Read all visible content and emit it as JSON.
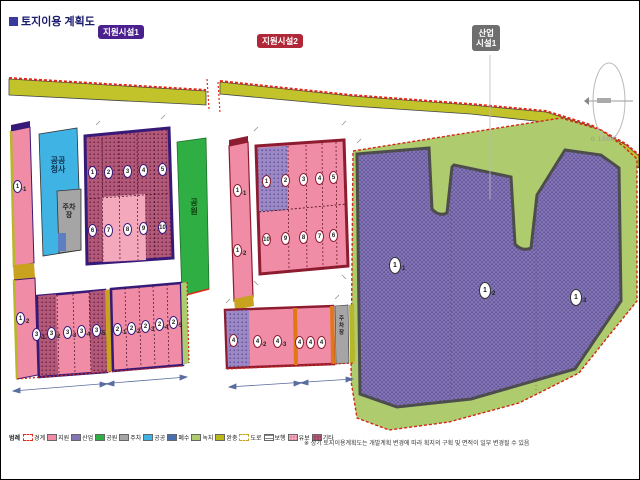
{
  "title": {
    "text": "토지이용 계획도"
  },
  "badges": {
    "support1": {
      "label": "지원시설1",
      "color": "#4a1f8e"
    },
    "support2": {
      "label": "지원시설2",
      "color": "#b02838"
    },
    "industry1": {
      "line1": "산업",
      "line2": "시설1",
      "color": "#6e6e6e"
    }
  },
  "north": {
    "scale": "0 100m"
  },
  "left": {
    "strip_top": {
      "n": "1",
      "s": "-1"
    },
    "strip_bottom": {
      "n": "1",
      "s": "-2"
    },
    "blue": {
      "l1": "공공",
      "l2": "청사"
    },
    "gray": {
      "l1": "주차",
      "l2": "장"
    },
    "park": {
      "l1": "공",
      "l2": "원"
    },
    "main": {
      "r1": [
        {
          "n": "1"
        },
        {
          "n": "2"
        },
        {
          "n": "3"
        },
        {
          "n": "4"
        },
        {
          "n": "5"
        }
      ],
      "r2": [
        {
          "n": "6"
        },
        {
          "n": "7"
        },
        {
          "n": "8"
        },
        {
          "n": "9"
        },
        {
          "n": "10"
        }
      ]
    },
    "ga": [
      {
        "n": "3",
        "s": "-1"
      },
      {
        "n": "3",
        "s": "-2"
      },
      {
        "n": "3",
        "s": "-3"
      },
      {
        "n": "3",
        "s": "-4"
      },
      {
        "n": "3",
        "s": "-5"
      }
    ],
    "gb": [
      {
        "n": "2",
        "s": "-1"
      },
      {
        "n": "2",
        "s": "-2"
      },
      {
        "n": "2",
        "s": "-3"
      },
      {
        "n": "2",
        "s": "-4"
      },
      {
        "n": "2",
        "s": "-5"
      }
    ]
  },
  "mid": {
    "strip": [
      {
        "n": "1",
        "s": "-1"
      },
      {
        "n": "1",
        "s": "-2"
      }
    ],
    "main": {
      "r1": [
        {
          "n": "1"
        },
        {
          "n": "2"
        },
        {
          "n": "3"
        },
        {
          "n": "4"
        },
        {
          "n": "5"
        }
      ],
      "r2": [
        {
          "n": "10"
        },
        {
          "n": "9"
        },
        {
          "n": "8"
        },
        {
          "n": "7"
        },
        {
          "n": "6"
        }
      ]
    },
    "bottom": [
      {
        "n": "4",
        "s": "-1"
      },
      {
        "n": "4",
        "s": "-2"
      },
      {
        "n": "4",
        "s": "-3"
      },
      {
        "n": "4",
        "s": "-4"
      },
      {
        "n": "4",
        "s": "-5"
      },
      {
        "n": "4",
        "s": "-6"
      }
    ],
    "gray": {
      "l1": "주",
      "l2": "차",
      "l3": "장"
    }
  },
  "right": {
    "lots": [
      {
        "n": "1",
        "s": "-1"
      },
      {
        "n": "1",
        "s": "-2"
      },
      {
        "n": "1",
        "s": "-3"
      }
    ]
  },
  "legend": {
    "intro": "범례",
    "items": [
      {
        "label": "경계"
      },
      {
        "label": "지원"
      },
      {
        "label": "산업"
      },
      {
        "label": "공원"
      },
      {
        "label": "주차"
      },
      {
        "label": "공공"
      },
      {
        "label": "폐수"
      },
      {
        "label": "녹지"
      },
      {
        "label": "완충"
      },
      {
        "label": "도로"
      },
      {
        "label": "보행"
      },
      {
        "label": "유보"
      },
      {
        "label": "기타"
      }
    ],
    "note": "※ 상기 토지이용계획도는 개발계획 변경에 따라 획지의 구획 및 면적이 일부 변경될 수 있음"
  },
  "colors": {
    "boundary_red": "#e02818",
    "buffer_olive": "#c2c22a",
    "parcel_pink": "#f08ca6",
    "parcel_pink_hatch": "#b25878",
    "border_purple": "#371a78",
    "border_darkred": "#8e1c30",
    "industry_purple": "#8374b4",
    "green_band": "#aecb6d",
    "park_green": "#2fae44",
    "public_blue": "#3fb3e3",
    "parking_gray": "#a5a5a5",
    "road_gold": "#c9a21f"
  }
}
